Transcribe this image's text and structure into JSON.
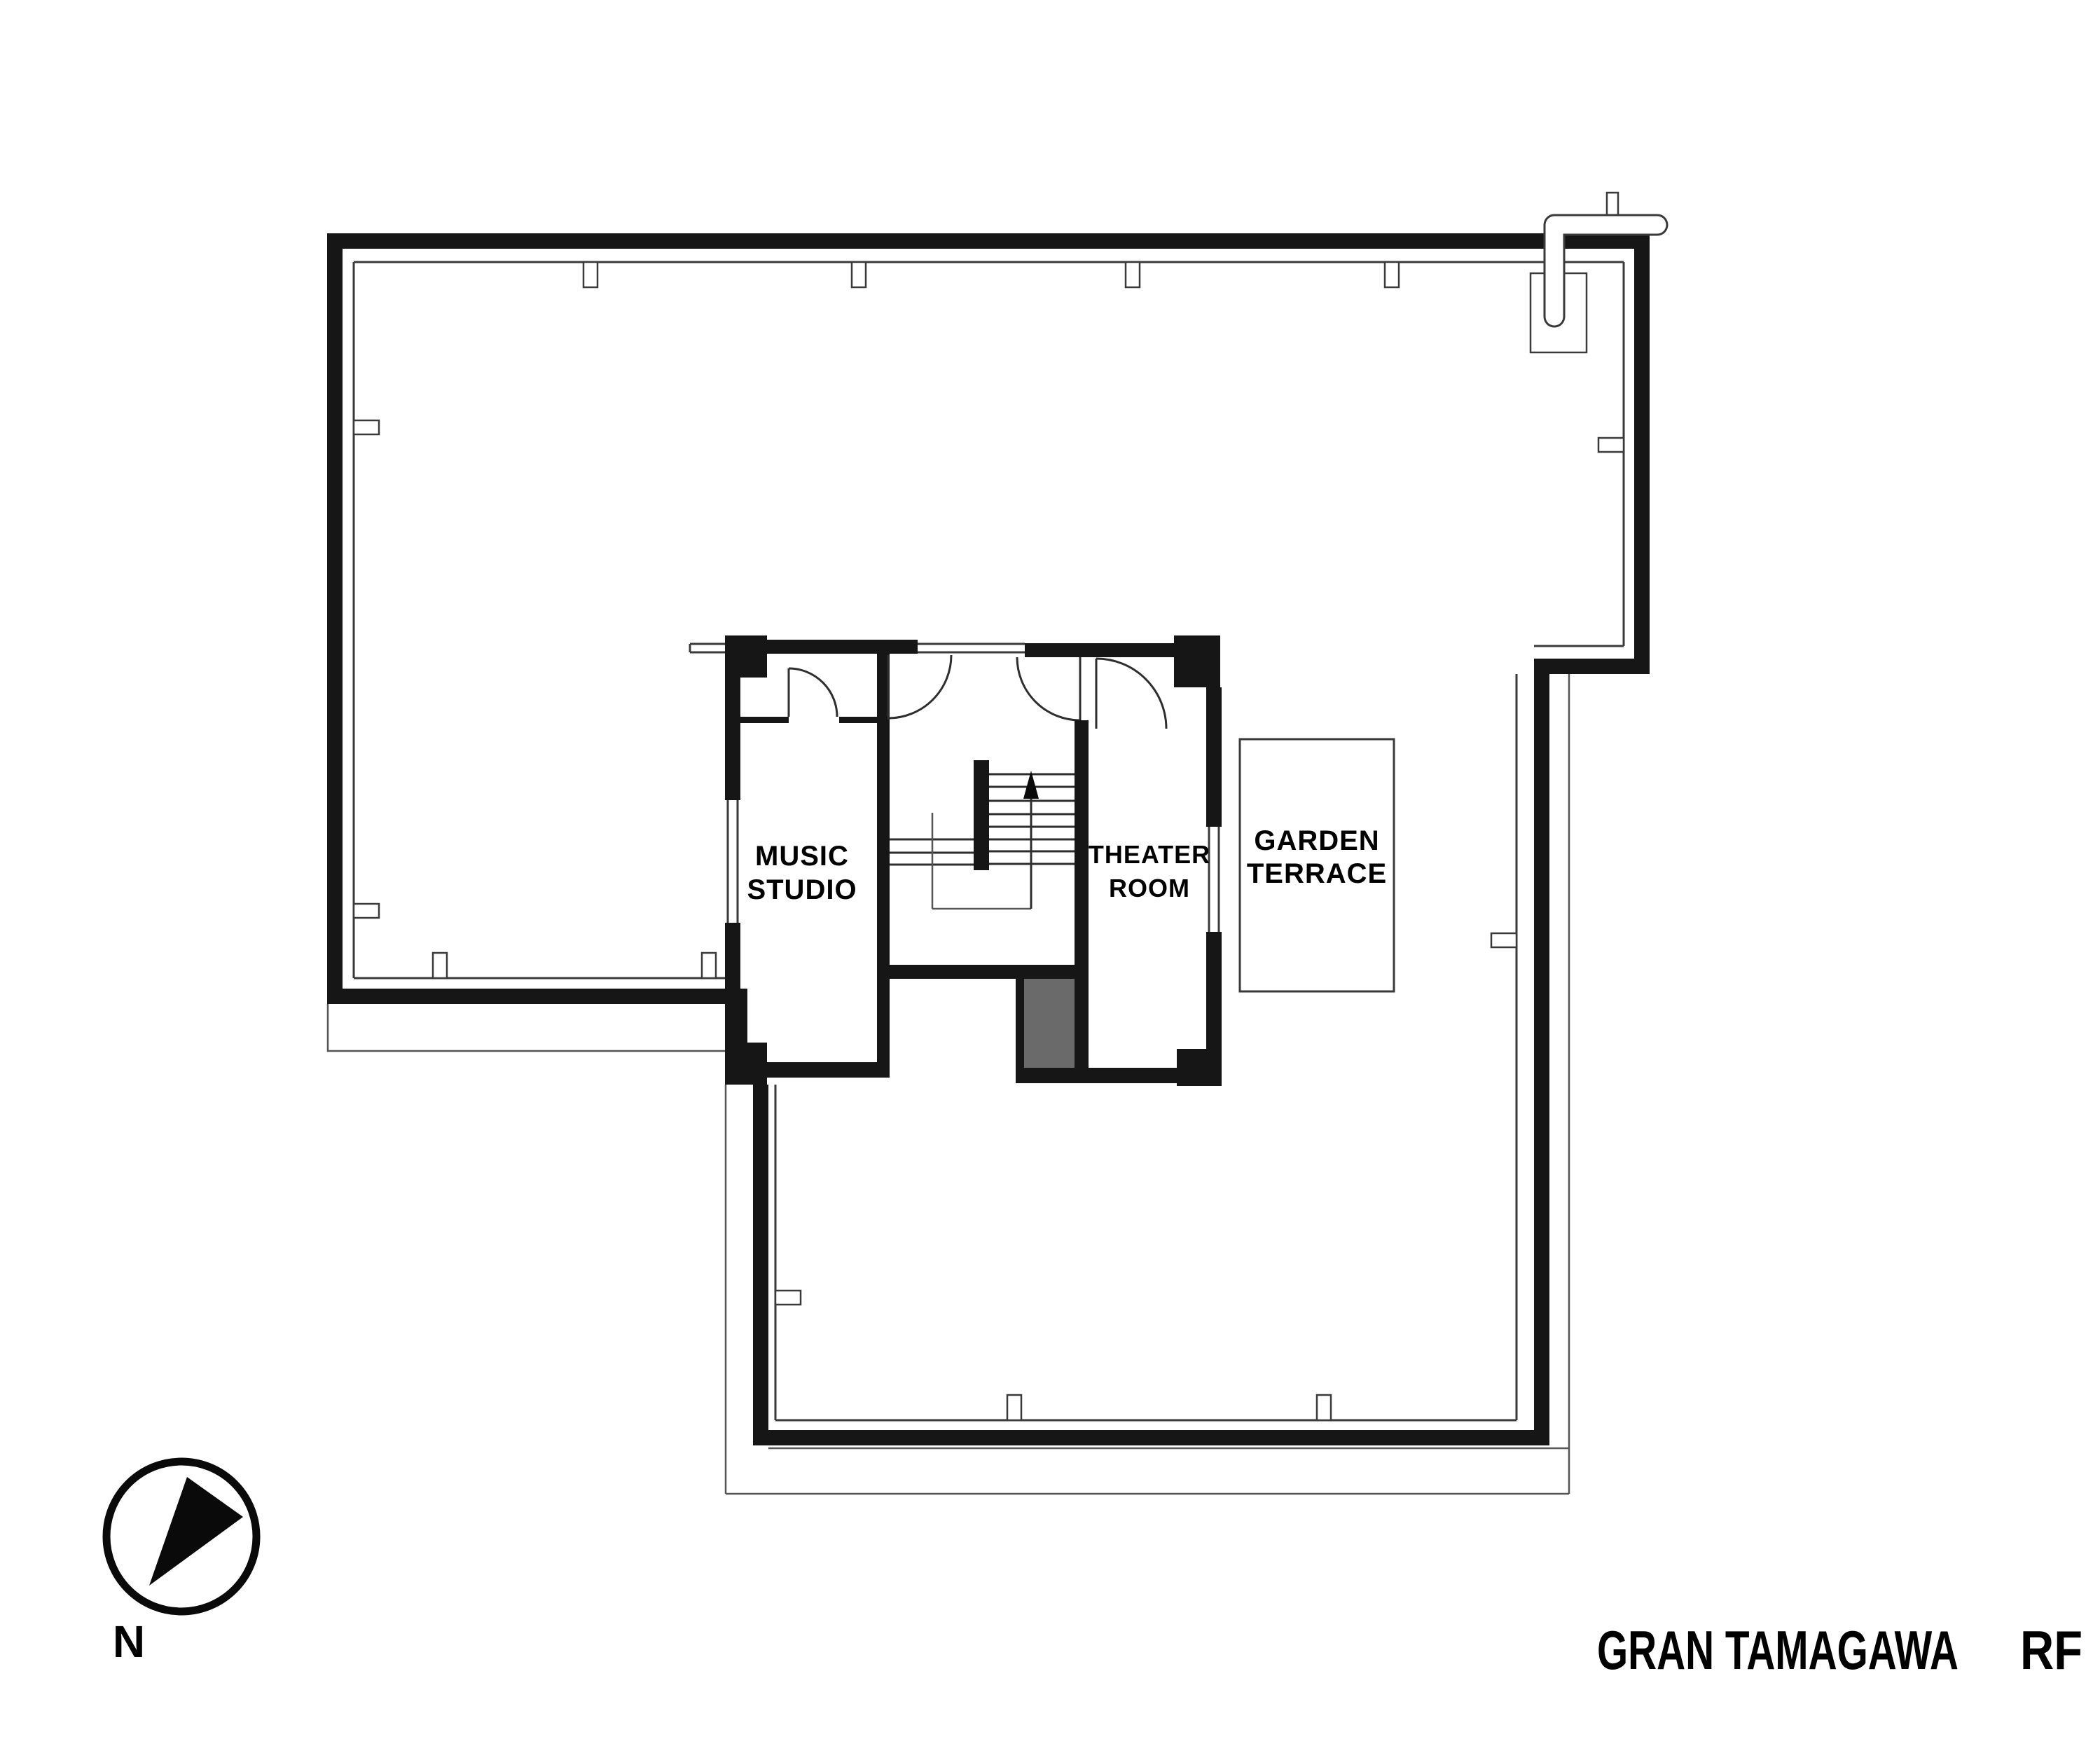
{
  "plan": {
    "rooms": {
      "music_studio": {
        "line1": "MUSIC",
        "line2": "STUDIO"
      },
      "theater_room": {
        "line1": "THEATER",
        "line2": "ROOM"
      },
      "garden_terrace": {
        "line1": "GARDEN",
        "line2": "TERRACE"
      }
    },
    "compass": {
      "label": "N"
    },
    "title": {
      "project": "GRAN TAMAGAWA",
      "floor": "RF"
    },
    "colors": {
      "wall": "#161616",
      "thin_line": "#3a3a3a",
      "shaft_fill": "#6a6a6a",
      "background": "#ffffff",
      "text": "#000000"
    },
    "icons": {
      "stairs": "up-arrow",
      "roof_drain": "drain-pipe",
      "north": "compass-needle"
    }
  }
}
